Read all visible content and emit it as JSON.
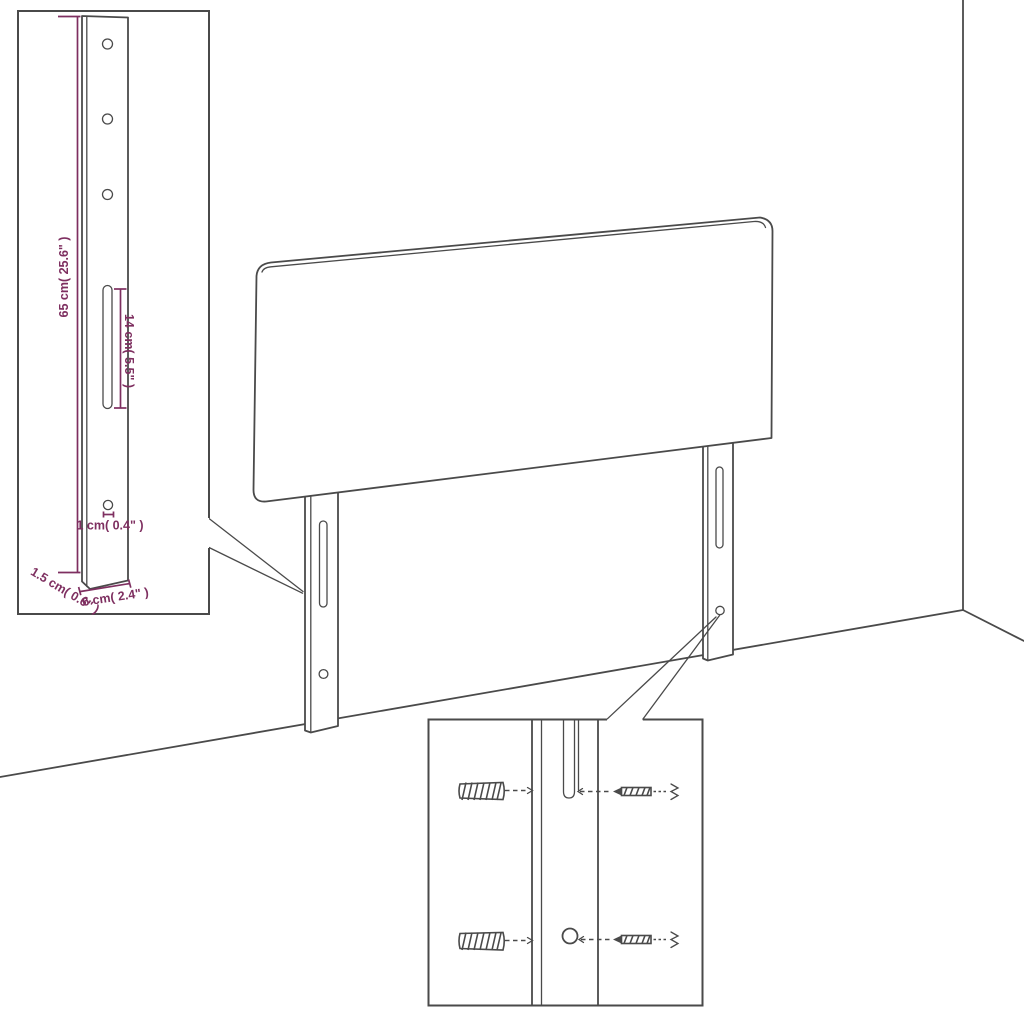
{
  "colors": {
    "line": "#4a4a4a",
    "dimension": "#7e2f60",
    "background": "#ffffff"
  },
  "insets": {
    "bracket_detail": {
      "dimensions": {
        "height": "65 cm( 25.6\" )",
        "slot_length": "14 cm( 5.5\" )",
        "hole": "1 cm( 0.4\" )",
        "thickness": "1.5 cm( 0.6\" )",
        "width": "6 cm( 2.4\" )"
      }
    }
  }
}
